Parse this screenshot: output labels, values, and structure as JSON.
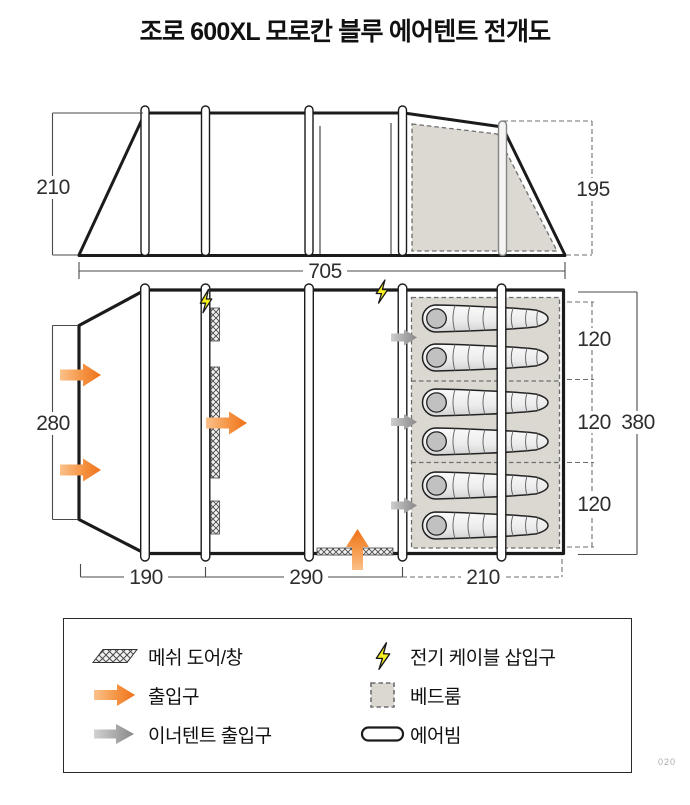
{
  "title": "조로 600XL 모로칸 블루 에어텐트 전개도",
  "elevation": {
    "left_height_label": "210",
    "right_height_label": "195",
    "length_label": "705"
  },
  "floorplan": {
    "front_depth_label": "280",
    "total_depth_label": "380",
    "bottom_segments": [
      "190",
      "290",
      "210"
    ],
    "bedroom_segments": [
      "120",
      "120",
      "120"
    ]
  },
  "legend": {
    "items": [
      {
        "id": "mesh-door-window",
        "label": "메쉬 도어/창"
      },
      {
        "id": "entrance",
        "label": "출입구"
      },
      {
        "id": "inner-tent-entrance",
        "label": "이너텐트 출입구"
      },
      {
        "id": "electric-cable-port",
        "label": "전기 케이블 삽입구"
      },
      {
        "id": "bedroom",
        "label": "베드룸"
      },
      {
        "id": "air-beam",
        "label": "에어빔"
      }
    ]
  },
  "footer": {
    "page_number": "020"
  },
  "colors": {
    "line": "#1b1b1b",
    "entrance_arrow": "#ee7118",
    "inner_entrance_arrow": "#8b8b8b",
    "bedroom_fill": "#dbd7d1",
    "lightning": "#f7ef1e"
  }
}
